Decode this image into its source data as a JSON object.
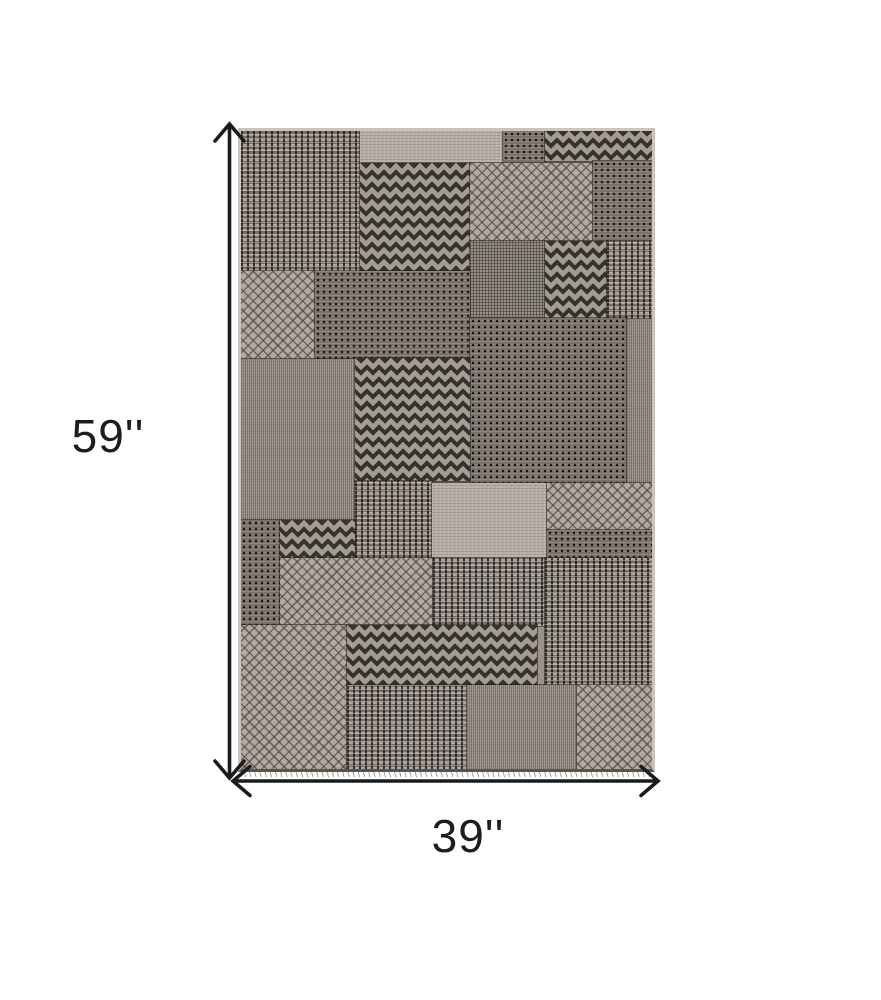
{
  "diagram": {
    "height_label": "59''",
    "width_label": "39''",
    "arrow_color": "#1b1b1b",
    "label_color": "#1d1d1d",
    "background_color": "#ffffff"
  },
  "rug": {
    "description": "gray taupe geometric patchwork area rug, top view",
    "base_color": "#9a928b",
    "selvage_color": "#cbc3bc",
    "seam_color": "#26221e",
    "texture_colors": {
      "light": "#b3aaa2",
      "dark": "#2e2b28",
      "mid": "#847c75"
    },
    "texture_types": [
      "basket",
      "dots",
      "chevron",
      "diamond",
      "plain",
      "grid",
      "weave"
    ],
    "patches": [
      {
        "tex": "basket",
        "x": 0,
        "y": 0,
        "w": 119,
        "h": 140
      },
      {
        "tex": "plain",
        "x": 119,
        "y": 0,
        "w": 143,
        "h": 32
      },
      {
        "tex": "dots",
        "x": 262,
        "y": 0,
        "w": 42,
        "h": 32
      },
      {
        "tex": "chevron",
        "x": 304,
        "y": 0,
        "w": 113,
        "h": 30
      },
      {
        "tex": "chevron",
        "x": 119,
        "y": 32,
        "w": 110,
        "h": 111
      },
      {
        "tex": "diamond",
        "x": 229,
        "y": 32,
        "w": 123,
        "h": 78
      },
      {
        "tex": "dots",
        "x": 352,
        "y": 30,
        "w": 65,
        "h": 80
      },
      {
        "tex": "grid",
        "x": 229,
        "y": 110,
        "w": 75,
        "h": 77
      },
      {
        "tex": "chevron",
        "x": 304,
        "y": 110,
        "w": 62,
        "h": 77
      },
      {
        "tex": "basket",
        "x": 366,
        "y": 110,
        "w": 51,
        "h": 78
      },
      {
        "tex": "diamond",
        "x": 0,
        "y": 140,
        "w": 74,
        "h": 88
      },
      {
        "tex": "dots",
        "x": 74,
        "y": 140,
        "w": 155,
        "h": 88
      },
      {
        "tex": "dots",
        "x": 229,
        "y": 187,
        "w": 157,
        "h": 165
      },
      {
        "tex": "weave",
        "x": 386,
        "y": 188,
        "w": 31,
        "h": 164
      },
      {
        "tex": "weave",
        "x": 0,
        "y": 228,
        "w": 114,
        "h": 161
      },
      {
        "tex": "chevron",
        "x": 114,
        "y": 227,
        "w": 115,
        "h": 123
      },
      {
        "tex": "basket",
        "x": 114,
        "y": 350,
        "w": 77,
        "h": 78
      },
      {
        "tex": "plain",
        "x": 191,
        "y": 352,
        "w": 115,
        "h": 75
      },
      {
        "tex": "diamond",
        "x": 306,
        "y": 352,
        "w": 111,
        "h": 47
      },
      {
        "tex": "dots",
        "x": 306,
        "y": 399,
        "w": 111,
        "h": 28
      },
      {
        "tex": "dots",
        "x": 0,
        "y": 389,
        "w": 39,
        "h": 105
      },
      {
        "tex": "chevron",
        "x": 39,
        "y": 389,
        "w": 75,
        "h": 38
      },
      {
        "tex": "diamond",
        "x": 39,
        "y": 427,
        "w": 153,
        "h": 67
      },
      {
        "tex": "basket",
        "x": 192,
        "y": 427,
        "w": 112,
        "h": 68
      },
      {
        "tex": "basket",
        "x": 304,
        "y": 427,
        "w": 113,
        "h": 127
      },
      {
        "tex": "diamond",
        "x": 0,
        "y": 494,
        "w": 106,
        "h": 149
      },
      {
        "tex": "chevron",
        "x": 106,
        "y": 494,
        "w": 190,
        "h": 60
      },
      {
        "tex": "basket",
        "x": 106,
        "y": 554,
        "w": 120,
        "h": 89
      },
      {
        "tex": "weave",
        "x": 226,
        "y": 554,
        "w": 110,
        "h": 89
      },
      {
        "tex": "diamond",
        "x": 336,
        "y": 554,
        "w": 81,
        "h": 89
      }
    ]
  }
}
